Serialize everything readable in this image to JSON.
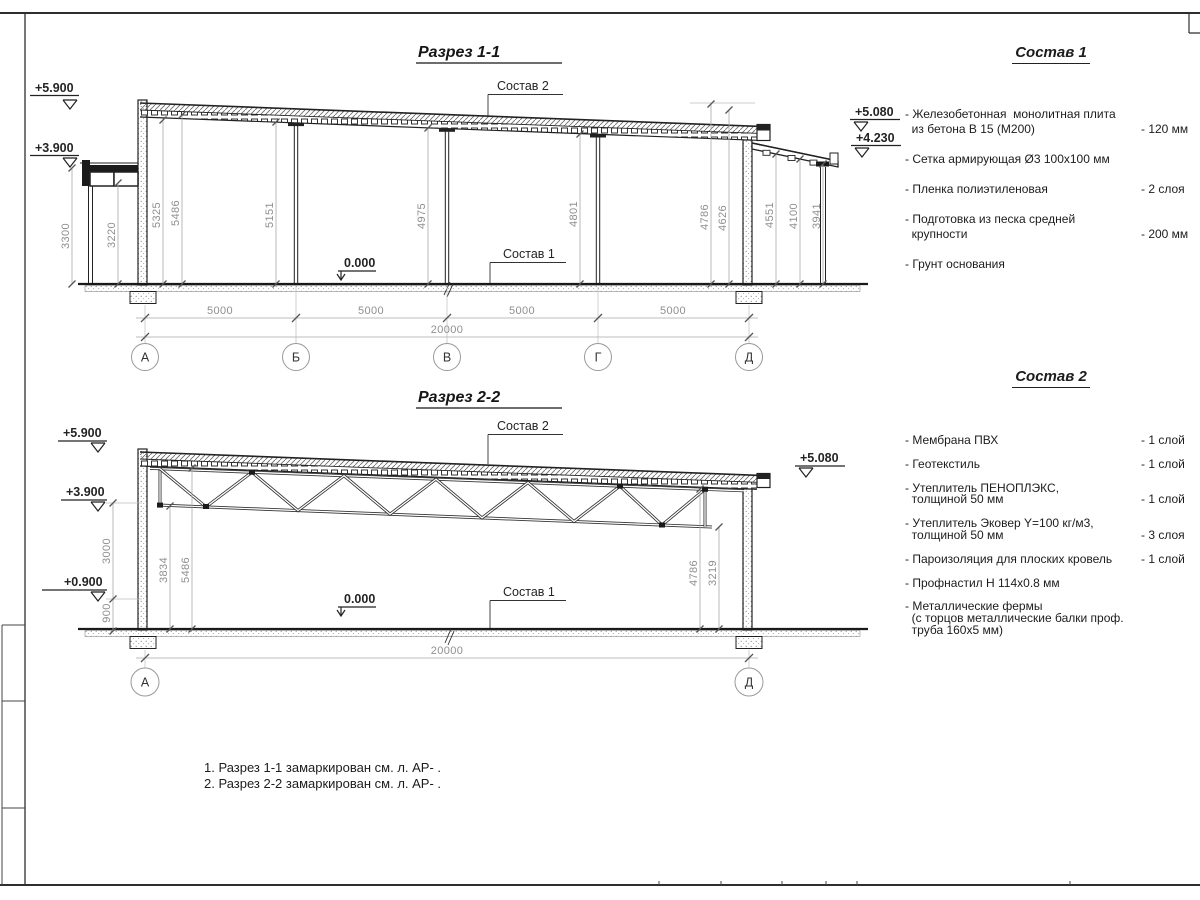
{
  "sections": {
    "s1": {
      "title": "Разрез 1-1",
      "callout_roof": "Состав 2",
      "callout_floor": "Состав 1",
      "elevations": {
        "e5900": "+5.900",
        "e3900": "+3.900",
        "e5080": "+5.080",
        "e4230": "+4.230",
        "zero": "0.000"
      },
      "vdims": {
        "v3300": "3300",
        "v3220": "3220",
        "v5325": "5325",
        "v5486": "5486",
        "v5151": "5151",
        "v4975": "4975",
        "v4801": "4801",
        "v4786": "4786",
        "v4626": "4626",
        "v4551": "4551",
        "v4100": "4100",
        "v3941": "3941"
      },
      "hdims": [
        "5000",
        "5000",
        "5000",
        "5000"
      ],
      "total": "20000",
      "axes": [
        "А",
        "Б",
        "В",
        "Г",
        "Д"
      ]
    },
    "s2": {
      "title": "Разрез 2-2",
      "callout_roof": "Состав 2",
      "callout_floor": "Состав 1",
      "elevations": {
        "e5900": "+5.900",
        "e3900": "+3.900",
        "e0900": "+0.900",
        "e5080": "+5.080",
        "zero": "0.000"
      },
      "vdims": {
        "v3000": "3000",
        "v900": "900",
        "v3834": "3834",
        "v5486": "5486",
        "v4786": "4786",
        "v3219": "3219"
      },
      "total": "20000",
      "axes": [
        "А",
        "Д"
      ]
    }
  },
  "comp1": {
    "title": "Состав 1",
    "items": [
      {
        "name": "- Железобетонная  монолитная плита\n  из бетона В 15 (М200)",
        "value": "- 120 мм"
      },
      {
        "name": "- Сетка армирующая Ø3 100х100 мм",
        "value": ""
      },
      {
        "name": "- Пленка полиэтиленовая",
        "value": "- 2 слоя"
      },
      {
        "name": "- Подготовка из песка средней\n  крупности",
        "value": "- 200 мм"
      },
      {
        "name": "- Грунт основания",
        "value": ""
      }
    ]
  },
  "comp2": {
    "title": "Состав 2",
    "items": [
      {
        "name": "- Мембрана ПВХ",
        "value": "- 1 слой"
      },
      {
        "name": "- Геотекстиль",
        "value": "- 1 слой"
      },
      {
        "name": "- Утеплитель ПЕНОПЛЭКС,\n  толщиной 50 мм",
        "value": "- 1 слой"
      },
      {
        "name": "- Утеплитель Эковер Y=100 кг/м3,\n  толщиной 50 мм",
        "value": "- 3 слоя"
      },
      {
        "name": "- Пароизоляция для плоских кровель",
        "value": "- 1 слой"
      },
      {
        "name": "- Профнастил Н 114х0.8 мм",
        "value": ""
      },
      {
        "name": "- Металлические фермы\n  (с торцов металлические балки проф.\n  труба 160х5 мм)",
        "value": ""
      }
    ]
  },
  "notes": [
    "1. Разрез 1-1 замаркирован см. л. АР- .",
    "2. Разрез 2-2 замаркирован см. л. АР- ."
  ]
}
